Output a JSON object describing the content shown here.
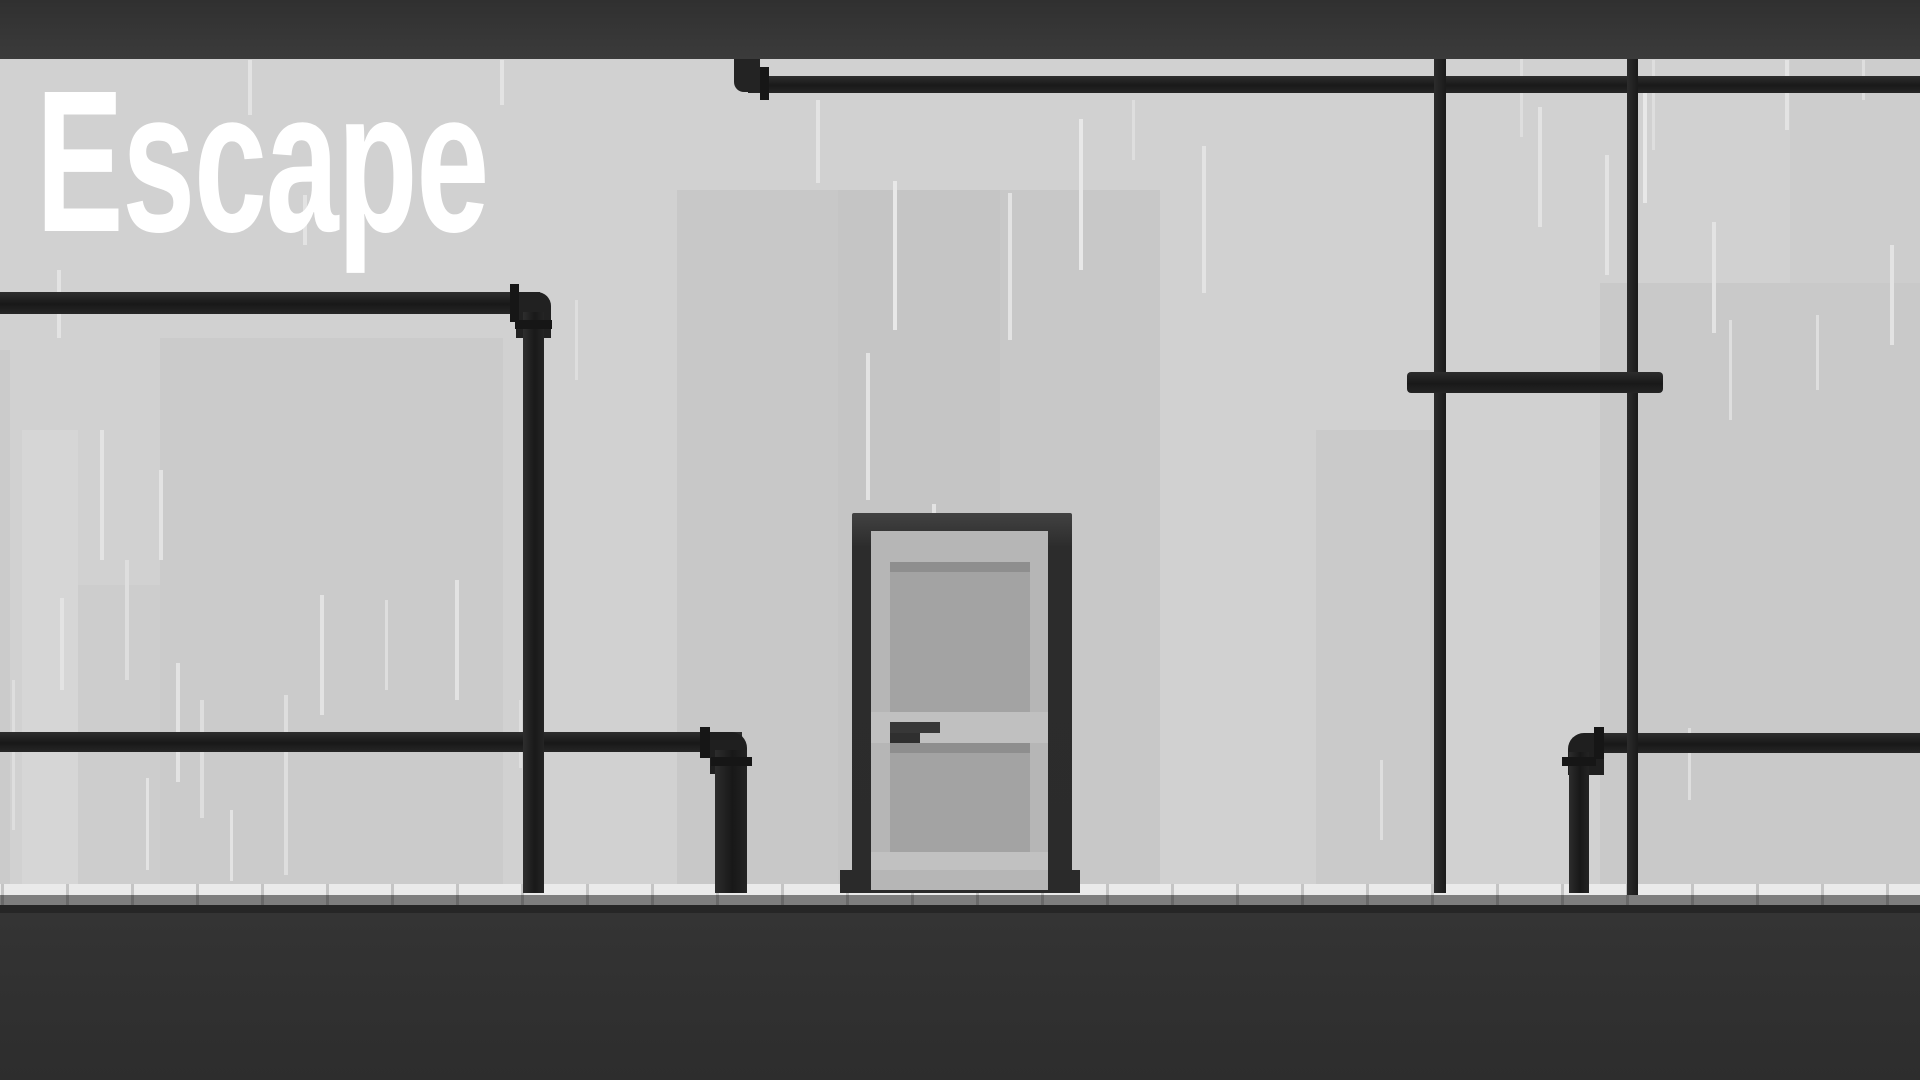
{
  "game": {
    "title": "Escape"
  },
  "palette": {
    "wall": "#d1d1d1",
    "ceiling_top": "#303030",
    "ceiling_bottom": "#3b3b3b",
    "pipe_dark": "#1a1a1a",
    "pipe_flange": "#161616",
    "door_frame": "#2b2b2b",
    "door_face": "#b6b6b6",
    "door_panel": "#a3a3a3",
    "door_handle": "#373737",
    "floor_tile": "#eaeaea",
    "floor_shadow": "#7e7e7e",
    "floor_dark": "#313131",
    "rain": "#e3e3e3",
    "title_color": "#ffffff"
  },
  "scene": {
    "width": 1920,
    "height": 1080,
    "rects": [
      {
        "n": "bg-building-left",
        "x": 160,
        "y": 338,
        "w": 343,
        "h": 546,
        "f": "#cbcbcb"
      },
      {
        "n": "bg-building-left-small",
        "x": 78,
        "y": 585,
        "w": 82,
        "h": 299,
        "f": "#cdcdcd"
      },
      {
        "n": "bg-band-left-light",
        "x": 22,
        "y": 430,
        "w": 56,
        "h": 454,
        "f": "#d6d6d6"
      },
      {
        "n": "bg-band-left-edge",
        "x": 0,
        "y": 350,
        "w": 10,
        "h": 534,
        "f": "#cbcbcb"
      },
      {
        "n": "bg-building-center",
        "x": 677,
        "y": 190,
        "w": 483,
        "h": 694,
        "f": "#c8c8c8"
      },
      {
        "n": "bg-building-center-inner",
        "x": 838,
        "y": 190,
        "w": 162,
        "h": 694,
        "f": "#c5c5c5"
      },
      {
        "n": "bg-building-mid-right",
        "x": 1316,
        "y": 430,
        "w": 124,
        "h": 454,
        "f": "#cacaca"
      },
      {
        "n": "bg-building-right",
        "x": 1600,
        "y": 283,
        "w": 320,
        "h": 601,
        "f": "#c9c9c9"
      },
      {
        "n": "bg-band-right-top",
        "x": 1790,
        "y": 59,
        "w": 130,
        "h": 224,
        "f": "#cdcdcd"
      },
      {
        "n": "rain-streak",
        "x": 57,
        "y": 270,
        "w": 4,
        "h": 68,
        "f": "#e3e3e3"
      },
      {
        "n": "rain-streak",
        "x": 100,
        "y": 430,
        "w": 4,
        "h": 130,
        "f": "#e3e3e3"
      },
      {
        "n": "rain-streak",
        "x": 12,
        "y": 680,
        "w": 3,
        "h": 150,
        "f": "#dedede"
      },
      {
        "n": "rain-streak",
        "x": 60,
        "y": 598,
        "w": 4,
        "h": 92,
        "f": "#e3e3e3"
      },
      {
        "n": "rain-streak",
        "x": 125,
        "y": 560,
        "w": 4,
        "h": 120,
        "f": "#dedede"
      },
      {
        "n": "rain-streak",
        "x": 146,
        "y": 778,
        "w": 3,
        "h": 92,
        "f": "#e3e3e3"
      },
      {
        "n": "rain-streak",
        "x": 159,
        "y": 470,
        "w": 4,
        "h": 90,
        "f": "#e3e3e3"
      },
      {
        "n": "rain-streak",
        "x": 176,
        "y": 663,
        "w": 4,
        "h": 119,
        "f": "#e3e3e3"
      },
      {
        "n": "rain-streak",
        "x": 200,
        "y": 700,
        "w": 4,
        "h": 118,
        "f": "#dedede"
      },
      {
        "n": "rain-streak",
        "x": 230,
        "y": 810,
        "w": 3,
        "h": 71,
        "f": "#e3e3e3"
      },
      {
        "n": "rain-streak",
        "x": 248,
        "y": 60,
        "w": 4,
        "h": 55,
        "f": "#e3e3e3"
      },
      {
        "n": "rain-streak",
        "x": 284,
        "y": 695,
        "w": 4,
        "h": 180,
        "f": "#dedede"
      },
      {
        "n": "rain-streak",
        "x": 303,
        "y": 195,
        "w": 4,
        "h": 50,
        "f": "#e3e3e3"
      },
      {
        "n": "rain-streak",
        "x": 320,
        "y": 595,
        "w": 4,
        "h": 120,
        "f": "#e3e3e3"
      },
      {
        "n": "rain-streak",
        "x": 385,
        "y": 600,
        "w": 3,
        "h": 90,
        "f": "#dedede"
      },
      {
        "n": "rain-streak",
        "x": 455,
        "y": 580,
        "w": 4,
        "h": 120,
        "f": "#e3e3e3"
      },
      {
        "n": "rain-streak",
        "x": 500,
        "y": 60,
        "w": 4,
        "h": 45,
        "f": "#e3e3e3"
      },
      {
        "n": "rain-streak",
        "x": 519,
        "y": 700,
        "w": 3,
        "h": 68,
        "f": "#dedede"
      },
      {
        "n": "rain-streak",
        "x": 575,
        "y": 300,
        "w": 3,
        "h": 80,
        "f": "#dedede"
      },
      {
        "n": "rain-streak",
        "x": 816,
        "y": 100,
        "w": 4,
        "h": 83,
        "f": "#e3e3e3"
      },
      {
        "n": "rain-streak",
        "x": 866,
        "y": 353,
        "w": 4,
        "h": 147,
        "f": "#e3e3e3"
      },
      {
        "n": "rain-streak",
        "x": 893,
        "y": 181,
        "w": 4,
        "h": 149,
        "f": "#e8e8e8"
      },
      {
        "n": "rain-streak",
        "x": 932,
        "y": 504,
        "w": 4,
        "h": 117,
        "f": "#e3e3e3"
      },
      {
        "n": "rain-streak",
        "x": 1008,
        "y": 193,
        "w": 4,
        "h": 147,
        "f": "#e3e3e3"
      },
      {
        "n": "rain-streak",
        "x": 1079,
        "y": 119,
        "w": 4,
        "h": 151,
        "f": "#e8e8e8"
      },
      {
        "n": "rain-streak",
        "x": 1132,
        "y": 100,
        "w": 3,
        "h": 60,
        "f": "#dedede"
      },
      {
        "n": "rain-streak",
        "x": 1202,
        "y": 146,
        "w": 4,
        "h": 147,
        "f": "#e3e3e3"
      },
      {
        "n": "rain-streak",
        "x": 1380,
        "y": 760,
        "w": 3,
        "h": 80,
        "f": "#dedede"
      },
      {
        "n": "rain-streak",
        "x": 1520,
        "y": 57,
        "w": 3,
        "h": 80,
        "f": "#dedede"
      },
      {
        "n": "rain-streak",
        "x": 1538,
        "y": 107,
        "w": 4,
        "h": 120,
        "f": "#e3e3e3"
      },
      {
        "n": "rain-streak",
        "x": 1605,
        "y": 155,
        "w": 4,
        "h": 120,
        "f": "#e3e3e3"
      },
      {
        "n": "rain-streak",
        "x": 1643,
        "y": 87,
        "w": 4,
        "h": 116,
        "f": "#e8e8e8"
      },
      {
        "n": "rain-streak",
        "x": 1652,
        "y": 60,
        "w": 3,
        "h": 90,
        "f": "#dedede"
      },
      {
        "n": "rain-streak",
        "x": 1688,
        "y": 728,
        "w": 3,
        "h": 72,
        "f": "#dedede"
      },
      {
        "n": "rain-streak",
        "x": 1712,
        "y": 222,
        "w": 4,
        "h": 111,
        "f": "#e3e3e3"
      },
      {
        "n": "rain-streak",
        "x": 1785,
        "y": 60,
        "w": 4,
        "h": 70,
        "f": "#e3e3e3"
      },
      {
        "n": "rain-streak",
        "x": 1729,
        "y": 320,
        "w": 3,
        "h": 100,
        "f": "#dedede"
      },
      {
        "n": "rain-streak",
        "x": 1816,
        "y": 315,
        "w": 3,
        "h": 75,
        "f": "#dedede"
      },
      {
        "n": "rain-streak",
        "x": 1890,
        "y": 245,
        "w": 4,
        "h": 100,
        "f": "#e3e3e3"
      },
      {
        "n": "rain-streak",
        "x": 1862,
        "y": 60,
        "w": 3,
        "h": 40,
        "f": "#dedede"
      },
      {
        "n": "floor-tile-row",
        "x": 0,
        "y": 884,
        "w": 1920,
        "h": 11,
        "f": "#eaeaea"
      },
      {
        "n": "floor-shadow-row",
        "x": 0,
        "y": 895,
        "w": 1920,
        "h": 10,
        "f": "#7e7e7e"
      },
      {
        "n": "floor-tile-separator",
        "x": 1,
        "y": 884,
        "w": 3,
        "h": 21,
        "f": "rgba(0,0,0,0.16)"
      },
      {
        "n": "floor-tile-separator",
        "x": 66,
        "y": 884,
        "w": 3,
        "h": 21,
        "f": "rgba(0,0,0,0.16)"
      },
      {
        "n": "floor-tile-separator",
        "x": 131,
        "y": 884,
        "w": 3,
        "h": 21,
        "f": "rgba(0,0,0,0.16)"
      },
      {
        "n": "floor-tile-separator",
        "x": 196,
        "y": 884,
        "w": 3,
        "h": 21,
        "f": "rgba(0,0,0,0.16)"
      },
      {
        "n": "floor-tile-separator",
        "x": 261,
        "y": 884,
        "w": 3,
        "h": 21,
        "f": "rgba(0,0,0,0.16)"
      },
      {
        "n": "floor-tile-separator",
        "x": 326,
        "y": 884,
        "w": 3,
        "h": 21,
        "f": "rgba(0,0,0,0.16)"
      },
      {
        "n": "floor-tile-separator",
        "x": 391,
        "y": 884,
        "w": 3,
        "h": 21,
        "f": "rgba(0,0,0,0.16)"
      },
      {
        "n": "floor-tile-separator",
        "x": 456,
        "y": 884,
        "w": 3,
        "h": 21,
        "f": "rgba(0,0,0,0.16)"
      },
      {
        "n": "floor-tile-separator",
        "x": 521,
        "y": 884,
        "w": 3,
        "h": 21,
        "f": "rgba(0,0,0,0.16)"
      },
      {
        "n": "floor-tile-separator",
        "x": 586,
        "y": 884,
        "w": 3,
        "h": 21,
        "f": "rgba(0,0,0,0.16)"
      },
      {
        "n": "floor-tile-separator",
        "x": 651,
        "y": 884,
        "w": 3,
        "h": 21,
        "f": "rgba(0,0,0,0.16)"
      },
      {
        "n": "floor-tile-separator",
        "x": 716,
        "y": 884,
        "w": 3,
        "h": 21,
        "f": "rgba(0,0,0,0.16)"
      },
      {
        "n": "floor-tile-separator",
        "x": 781,
        "y": 884,
        "w": 3,
        "h": 21,
        "f": "rgba(0,0,0,0.16)"
      },
      {
        "n": "floor-tile-separator",
        "x": 846,
        "y": 884,
        "w": 3,
        "h": 21,
        "f": "rgba(0,0,0,0.16)"
      },
      {
        "n": "floor-tile-separator",
        "x": 911,
        "y": 884,
        "w": 3,
        "h": 21,
        "f": "rgba(0,0,0,0.16)"
      },
      {
        "n": "floor-tile-separator",
        "x": 976,
        "y": 884,
        "w": 3,
        "h": 21,
        "f": "rgba(0,0,0,0.16)"
      },
      {
        "n": "floor-tile-separator",
        "x": 1041,
        "y": 884,
        "w": 3,
        "h": 21,
        "f": "rgba(0,0,0,0.16)"
      },
      {
        "n": "floor-tile-separator",
        "x": 1106,
        "y": 884,
        "w": 3,
        "h": 21,
        "f": "rgba(0,0,0,0.16)"
      },
      {
        "n": "floor-tile-separator",
        "x": 1171,
        "y": 884,
        "w": 3,
        "h": 21,
        "f": "rgba(0,0,0,0.16)"
      },
      {
        "n": "floor-tile-separator",
        "x": 1236,
        "y": 884,
        "w": 3,
        "h": 21,
        "f": "rgba(0,0,0,0.16)"
      },
      {
        "n": "floor-tile-separator",
        "x": 1301,
        "y": 884,
        "w": 3,
        "h": 21,
        "f": "rgba(0,0,0,0.16)"
      },
      {
        "n": "floor-tile-separator",
        "x": 1366,
        "y": 884,
        "w": 3,
        "h": 21,
        "f": "rgba(0,0,0,0.16)"
      },
      {
        "n": "floor-tile-separator",
        "x": 1431,
        "y": 884,
        "w": 3,
        "h": 21,
        "f": "rgba(0,0,0,0.16)"
      },
      {
        "n": "floor-tile-separator",
        "x": 1496,
        "y": 884,
        "w": 3,
        "h": 21,
        "f": "rgba(0,0,0,0.16)"
      },
      {
        "n": "floor-tile-separator",
        "x": 1561,
        "y": 884,
        "w": 3,
        "h": 21,
        "f": "rgba(0,0,0,0.16)"
      },
      {
        "n": "floor-tile-separator",
        "x": 1626,
        "y": 884,
        "w": 3,
        "h": 21,
        "f": "rgba(0,0,0,0.16)"
      },
      {
        "n": "floor-tile-separator",
        "x": 1691,
        "y": 884,
        "w": 3,
        "h": 21,
        "f": "rgba(0,0,0,0.16)"
      },
      {
        "n": "floor-tile-separator",
        "x": 1756,
        "y": 884,
        "w": 3,
        "h": 21,
        "f": "rgba(0,0,0,0.16)"
      },
      {
        "n": "floor-tile-separator",
        "x": 1821,
        "y": 884,
        "w": 3,
        "h": 21,
        "f": "rgba(0,0,0,0.16)"
      },
      {
        "n": "floor-tile-separator",
        "x": 1886,
        "y": 884,
        "w": 3,
        "h": 21,
        "f": "rgba(0,0,0,0.16)"
      },
      {
        "n": "floor-edge-dark",
        "x": 0,
        "y": 905,
        "w": 1920,
        "h": 8,
        "f": "#262626"
      },
      {
        "n": "floor-dark",
        "x": 0,
        "y": 913,
        "w": 1920,
        "h": 167,
        "f": "linear-gradient(180deg,#343434,#2d2d2d)"
      },
      {
        "n": "pipe-top-right-horizontal",
        "x": 748,
        "y": 76,
        "w": 1172,
        "h": 17,
        "f": "linear-gradient(180deg,#2e2e2e,#191919 55%,#262626)"
      },
      {
        "n": "pipe-top-right-elbow",
        "x": 734,
        "y": 59,
        "w": 26,
        "h": 33,
        "f": "#232323",
        "r": "0 0 0 10px"
      },
      {
        "n": "pipe-top-right-flange",
        "x": 760,
        "y": 67,
        "w": 9,
        "h": 33,
        "f": "#161616"
      },
      {
        "n": "pipe-left-horizontal",
        "x": 0,
        "y": 292,
        "w": 540,
        "h": 22,
        "f": "linear-gradient(180deg,#2e2e2e,#181818 55%,#262626)"
      },
      {
        "n": "pipe-left-elbow",
        "x": 516,
        "y": 292,
        "w": 35,
        "h": 46,
        "f": "#212121",
        "r": "0 14px 0 0"
      },
      {
        "n": "pipe-left-flange-horizontal",
        "x": 510,
        "y": 284,
        "w": 9,
        "h": 38,
        "f": "#161616"
      },
      {
        "n": "pipe-bottom-left-horizontal",
        "x": 0,
        "y": 732,
        "w": 742,
        "h": 20,
        "f": "linear-gradient(180deg,#2e2e2e,#181818 55%,#262626)"
      },
      {
        "n": "pipe-left-vertical",
        "x": 523,
        "y": 312,
        "w": 21,
        "h": 581,
        "f": "linear-gradient(90deg,#2e2e2e,#191919 55%,#242424)"
      },
      {
        "n": "pipe-left-vertical-flange",
        "x": 515,
        "y": 320,
        "w": 37,
        "h": 9,
        "f": "#161616"
      },
      {
        "n": "pipe-bottom-left-elbow",
        "x": 710,
        "y": 732,
        "w": 37,
        "h": 42,
        "f": "#1f1f1f",
        "r": "0 16px 0 0"
      },
      {
        "n": "pipe-bottom-left-vertical",
        "x": 715,
        "y": 750,
        "w": 32,
        "h": 143,
        "f": "linear-gradient(90deg,#2d2d2d,#181818 55%,#232323)"
      },
      {
        "n": "pipe-bottom-left-flange-horizontal",
        "x": 700,
        "y": 727,
        "w": 10,
        "h": 31,
        "f": "#161616"
      },
      {
        "n": "pipe-bottom-left-flange-vertical",
        "x": 711,
        "y": 757,
        "w": 41,
        "h": 9,
        "f": "#161616"
      },
      {
        "n": "pipe-bottom-right-horizontal",
        "x": 1585,
        "y": 733,
        "w": 335,
        "h": 20,
        "f": "linear-gradient(180deg,#2e2e2e,#181818 55%,#262626)"
      },
      {
        "n": "pipe-bottom-right-elbow",
        "x": 1568,
        "y": 733,
        "w": 36,
        "h": 42,
        "f": "#1f1f1f",
        "r": "16px 0 0 0"
      },
      {
        "n": "pipe-bottom-right-vertical",
        "x": 1569,
        "y": 752,
        "w": 20,
        "h": 141,
        "f": "linear-gradient(90deg,#2d2d2d,#181818 55%,#232323)"
      },
      {
        "n": "pipe-bottom-right-flange-horizontal",
        "x": 1594,
        "y": 727,
        "w": 10,
        "h": 32,
        "f": "#161616"
      },
      {
        "n": "pipe-bottom-right-flange-vertical",
        "x": 1562,
        "y": 757,
        "w": 34,
        "h": 9,
        "f": "#161616"
      },
      {
        "n": "pipe-right-vertical-1",
        "x": 1434,
        "y": 59,
        "w": 12,
        "h": 834,
        "f": "linear-gradient(90deg,#2c2c2c,#1a1a1a)"
      },
      {
        "n": "pipe-right-vertical-2",
        "x": 1627,
        "y": 59,
        "w": 11,
        "h": 836,
        "f": "linear-gradient(90deg,#2c2c2c,#1a1a1a)"
      },
      {
        "n": "pipe-right-connector",
        "x": 1407,
        "y": 372,
        "w": 256,
        "h": 21,
        "f": "linear-gradient(180deg,#2d2d2d,#191919 55%,#242424)",
        "r": "4px"
      },
      {
        "n": "door",
        "x": 852,
        "y": 513,
        "w": 220,
        "h": 380,
        "f": "linear-gradient(180deg,#424242,#2c2c2c 9%,#2b2b2b)",
        "r": "2px 2px 0 0",
        "i": true
      },
      {
        "n": "door-face",
        "x": 871,
        "y": 531,
        "w": 177,
        "h": 359,
        "f": "#b6b6b6"
      },
      {
        "n": "door-window-bevel",
        "x": 890,
        "y": 562,
        "w": 140,
        "h": 10,
        "f": "#8e8e8e"
      },
      {
        "n": "door-window",
        "x": 890,
        "y": 572,
        "w": 140,
        "h": 140,
        "f": "#a3a3a3"
      },
      {
        "n": "door-mid-rail",
        "x": 871,
        "y": 712,
        "w": 177,
        "h": 31,
        "f": "#c0c0c0"
      },
      {
        "n": "door-handle",
        "x": 890,
        "y": 722,
        "w": 50,
        "h": 11,
        "f": "#373737",
        "i": true
      },
      {
        "n": "door-handle-base",
        "x": 890,
        "y": 733,
        "w": 30,
        "h": 10,
        "f": "#2f2f2f",
        "i": true
      },
      {
        "n": "door-panel-bevel",
        "x": 890,
        "y": 743,
        "w": 140,
        "h": 10,
        "f": "#8e8e8e"
      },
      {
        "n": "door-panel",
        "x": 890,
        "y": 753,
        "w": 140,
        "h": 99,
        "f": "#a3a3a3"
      },
      {
        "n": "door-kick-strip",
        "x": 871,
        "y": 852,
        "w": 177,
        "h": 18,
        "f": "#c1c1c1"
      },
      {
        "n": "door-foot-left",
        "x": 840,
        "y": 870,
        "w": 31,
        "h": 23,
        "f": "#2a2a2a"
      },
      {
        "n": "door-foot-right",
        "x": 1048,
        "y": 870,
        "w": 32,
        "h": 23,
        "f": "#2a2a2a"
      },
      {
        "n": "ceiling-bar",
        "x": 0,
        "y": 0,
        "w": 1920,
        "h": 59,
        "f": "linear-gradient(180deg,#303030,#3b3b3b)"
      }
    ]
  }
}
